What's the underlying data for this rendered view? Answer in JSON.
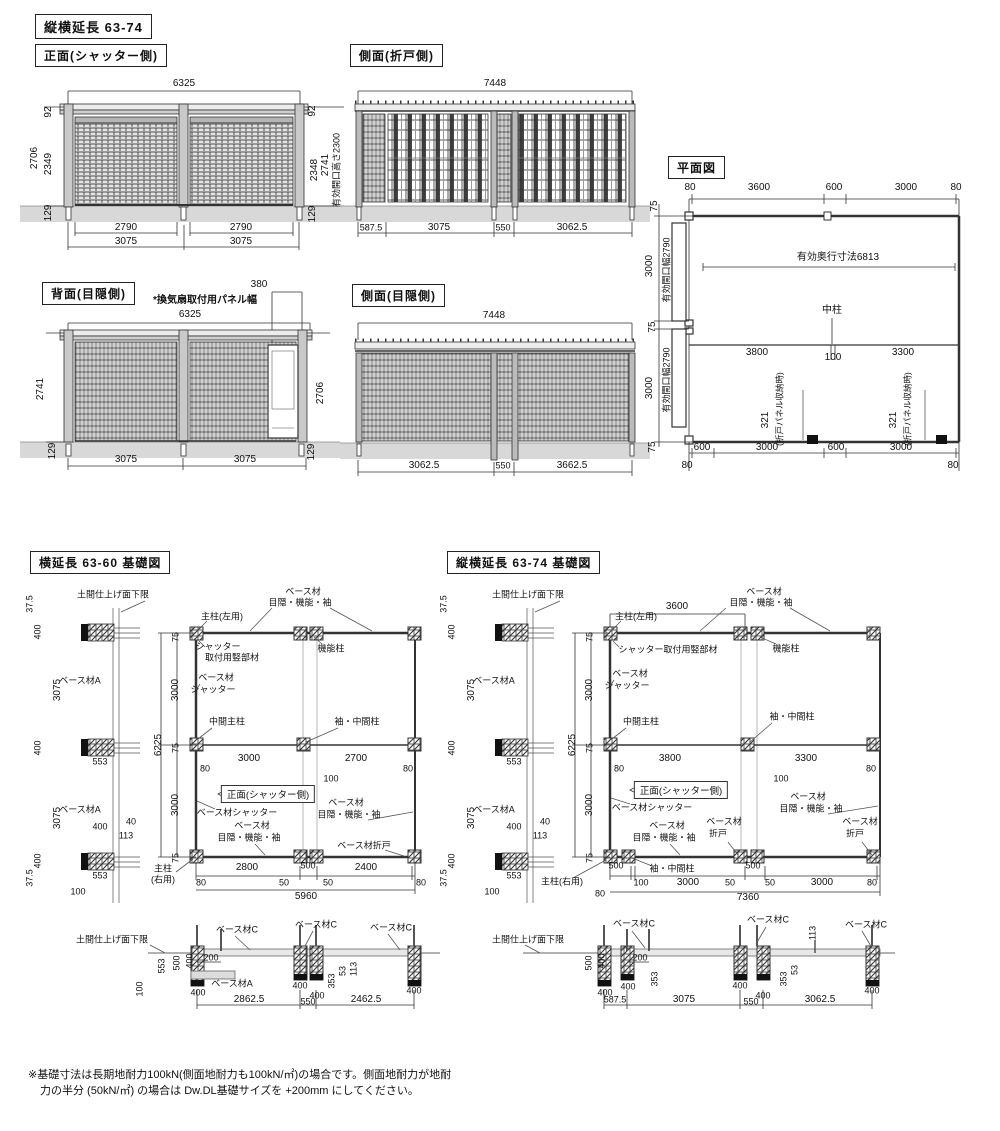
{
  "main_title": "縦横延長 63-74",
  "front": {
    "title": "正面(シャッター側)",
    "w": "6325",
    "l92": "92",
    "l2349": "2349",
    "l2706": "2706",
    "l129": "129",
    "r92": "92",
    "r2348": "2348",
    "r2741": "2741",
    "ropen": "有効開口高さ2300",
    "r129": "129",
    "bi": [
      "2790",
      "2790"
    ],
    "bo": [
      "3075",
      "3075"
    ]
  },
  "sidefold": {
    "title": "側面(折戸側)",
    "w": "7448",
    "b": [
      "587.5",
      "3075",
      "550",
      "3062.5"
    ]
  },
  "plan": {
    "title": "平面図",
    "top": [
      "80",
      "3600",
      "600",
      "3000",
      "80"
    ],
    "leftout": [
      "75",
      "3000",
      "75",
      "3000",
      "75"
    ],
    "opening": "有効開口幅2790",
    "depth": "有効奥行寸法6813",
    "naka": "中柱",
    "mid": [
      "3800",
      "100",
      "3300"
    ],
    "fold_num": "321",
    "fold_note": "(折戸パネル収納時)",
    "bottom": [
      "600",
      "3000",
      "600",
      "3000"
    ],
    "b80l": "80",
    "b80r": "80"
  },
  "back": {
    "title": "背面(目隠側)",
    "vent": "*換気扇取付用パネル幅",
    "d380": "380",
    "w": "6325",
    "l2741": "2741",
    "l129": "129",
    "r2706": "2706",
    "r129": "129",
    "b": [
      "3075",
      "3075"
    ]
  },
  "sideprivacy": {
    "title": "側面(目隠側)",
    "w": "7448",
    "b": [
      "3062.5",
      "550",
      "3662.5"
    ]
  },
  "fl": {
    "title": "横延長 63-60 基礎図",
    "floor": "土間仕上げ面下限",
    "strip": {
      "a": "37.5",
      "b": "400",
      "c": "3075",
      "c2": "ベース材A",
      "d": "400",
      "e": "553",
      "f": "3075",
      "f2": "ベース材A",
      "g": "400",
      "h": "40",
      "i": "113",
      "j": "400",
      "k": "553",
      "l": "37.5",
      "m": "100"
    },
    "postl1": "主柱(左用)",
    "shmember1": "シャッター",
    "shmember2": "取付用竪部材",
    "baset1": "ベース材",
    "baset2": "目隠・機能・袖",
    "func": "機能柱",
    "bases1": "ベース材",
    "bases2": "シャッター",
    "nakapost": "中間主柱",
    "sodepost": "袖・中間柱",
    "v": [
      "75",
      "3000",
      "75",
      "3000",
      "75"
    ],
    "v6225": "6225",
    "mid": [
      "80",
      "3000",
      "100",
      "2700",
      "80"
    ],
    "arrow": "正面(シャッター側)",
    "baseshut": "ベース材シャッター",
    "basemk1": "ベース材",
    "basemk2": "目隠・機能・袖",
    "basemk3": "ベース材",
    "basemk4": "目隠・機能・袖",
    "orido": "ベース材折戸",
    "postr1": "主柱",
    "postr2": "(右用)",
    "chain": [
      "2800",
      "500",
      "2400"
    ],
    "small": [
      "80",
      "50",
      "50",
      "80"
    ],
    "total": "5960",
    "sec": {
      "floor": "土間仕上げ面下限",
      "c1": "ベース材C",
      "c2": "ベース材C",
      "c3": "ベース材C",
      "l553": "553",
      "l500": "500",
      "l400": "400",
      "l100": "100",
      "d200": "200",
      "basea": "ベース材A",
      "p1": "400",
      "p2": "400",
      "p3": "400",
      "p4": "400",
      "r353": "353",
      "r53": "53",
      "r113": "113",
      "b": [
        "2862.5",
        "550",
        "2462.5"
      ]
    }
  },
  "fr": {
    "title": "縦横延長 63-74 基礎図",
    "floor": "土間仕上げ面下限",
    "strip": {
      "a": "37.5",
      "b": "400",
      "c": "3075",
      "c2": "ベース材A",
      "d": "400",
      "e": "553",
      "f": "3075",
      "f2": "ベース材A",
      "g": "400",
      "h": "40",
      "i": "113",
      "j": "400",
      "k": "553",
      "l": "37.5",
      "m": "100"
    },
    "top3600": "3600",
    "postl1": "主柱(左用)",
    "shmember": "シャッター取付用竪部材",
    "baset1": "ベース材",
    "baset2": "目隠・機能・袖",
    "func": "機能柱",
    "bases1": "ベース材",
    "bases2": "シャッター",
    "nakapost": "中間主柱",
    "sodepost": "袖・中間柱",
    "v": [
      "75",
      "3000",
      "75",
      "3000",
      "75"
    ],
    "v6225": "6225",
    "mid": [
      "80",
      "3800",
      "100",
      "3300",
      "80"
    ],
    "arrow": "正面(シャッター側)",
    "baseshut": "ベース材シャッター",
    "basemk1": "ベース材",
    "basemk2": "目隠・機能・袖",
    "orido1a": "ベース材",
    "orido1b": "折戸",
    "basemk3": "ベース材",
    "basemk4": "目隠・機能・袖",
    "orido2a": "ベース材",
    "orido2b": "折戸",
    "postr1": "主柱(右用)",
    "sodebottom": "袖・中間柱",
    "d500a": "500",
    "d500b": "500",
    "chain": [
      "100",
      "3000",
      "50",
      "50",
      "3000",
      "80"
    ],
    "b80": "80",
    "total": "7360",
    "sec": {
      "floor": "土間仕上げ面下限",
      "c1": "ベース材C",
      "c2": "ベース材C",
      "c3": "ベース材C",
      "l500": "500",
      "l400": "400",
      "d200": "200",
      "r113": "113",
      "r353a": "353",
      "r353b": "353",
      "r53": "53",
      "p1": "400",
      "p2": "400",
      "p3": "400",
      "p4": "400",
      "p5": "400",
      "b": [
        "587.5",
        "3075",
        "550",
        "3062.5"
      ]
    }
  },
  "footnote": {
    "line1": "※基礎寸法は長期地耐力100kN(側面地耐力も100kN/㎡)の場合です。側面地耐力が地耐",
    "line2": "力の半分 (50kN/㎡) の場合は Dw.DL基礎サイズを +200mm にしてください。"
  }
}
